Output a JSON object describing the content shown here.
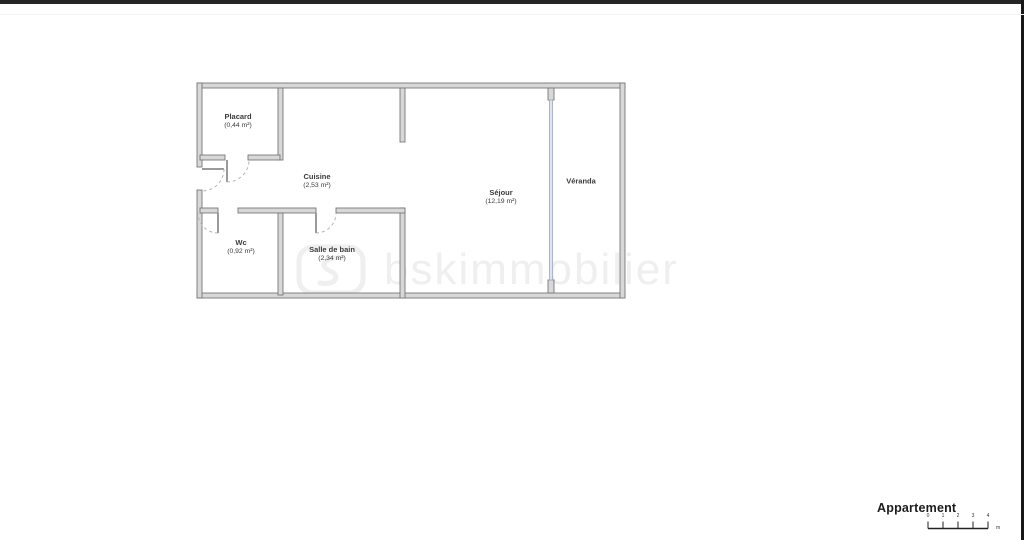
{
  "watermark": {
    "text": "bskimmobilier"
  },
  "rooms": [
    {
      "name": "Placard",
      "area": "(0,44 m²)"
    },
    {
      "name": "Cuisine",
      "area": "(2,53 m²)"
    },
    {
      "name": "Wc",
      "area": "(0,92 m²)"
    },
    {
      "name": "Salle de bain",
      "area": "(2,34 m²)"
    },
    {
      "name": "Séjour",
      "area": "(12,19 m²)"
    },
    {
      "name": "Véranda",
      "area": ""
    }
  ],
  "title_block": {
    "title": "Appartement",
    "unit": "m"
  },
  "scalebar": {
    "ticks": [
      "0",
      "1",
      "2",
      "3",
      "4"
    ]
  },
  "colors": {
    "wall_fill": "#d8d8d8",
    "wall_stroke": "#787878",
    "glazing_fill": "#dfe3ee",
    "glazing_stroke": "#a6aec6",
    "label_text": "#3b3b3b",
    "watermark": "#efefef",
    "border_bar": "#252525"
  }
}
